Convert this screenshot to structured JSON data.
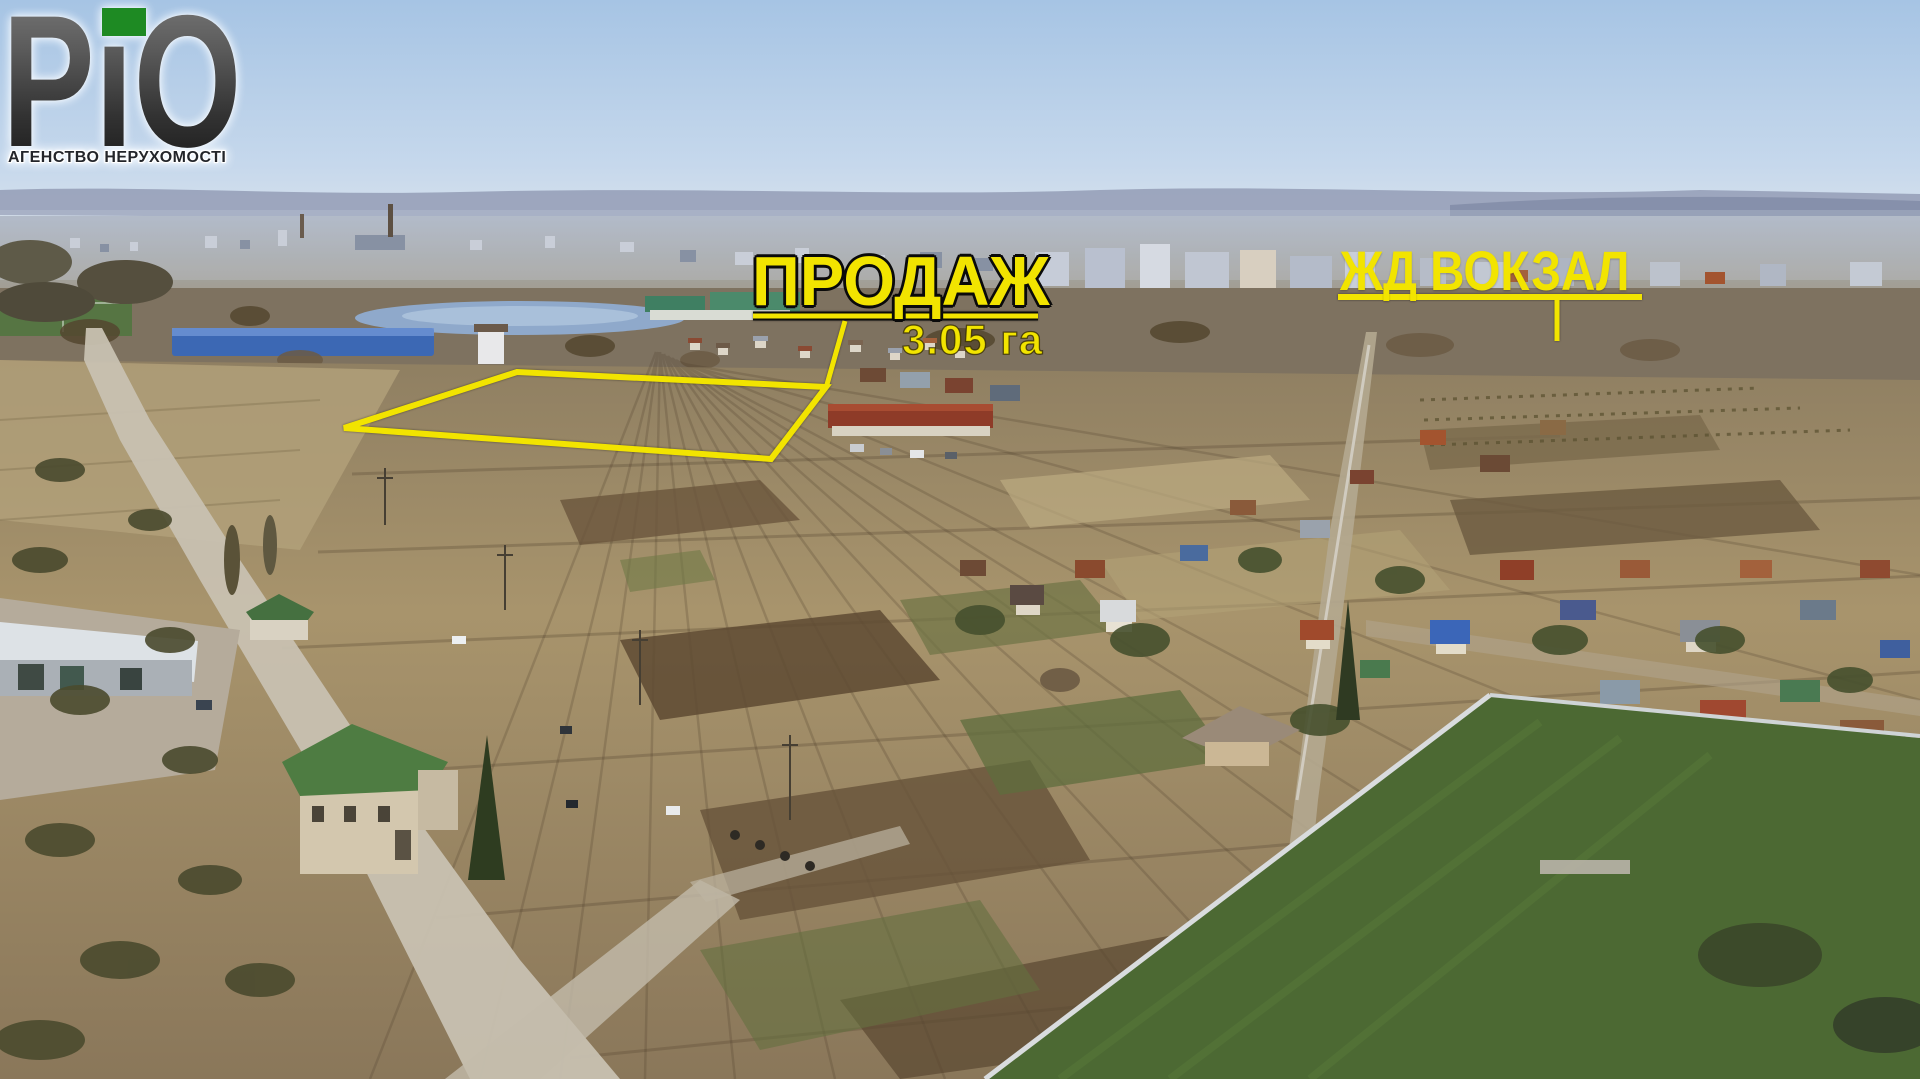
{
  "brand": {
    "name": "РіО",
    "tagline": "АГЕНСТВО НЕРУХОМОСТІ",
    "accent_green": "#1e8a23",
    "name_gradient_top": "#7b7b7b",
    "name_gradient_bottom": "#191919"
  },
  "annotations": {
    "highlight_yellow": "#f2e400",
    "sale": {
      "label": "ПРОДАЖ",
      "area": "3.05 га"
    },
    "station": {
      "label": "ЖД ВОКЗАЛ"
    }
  }
}
